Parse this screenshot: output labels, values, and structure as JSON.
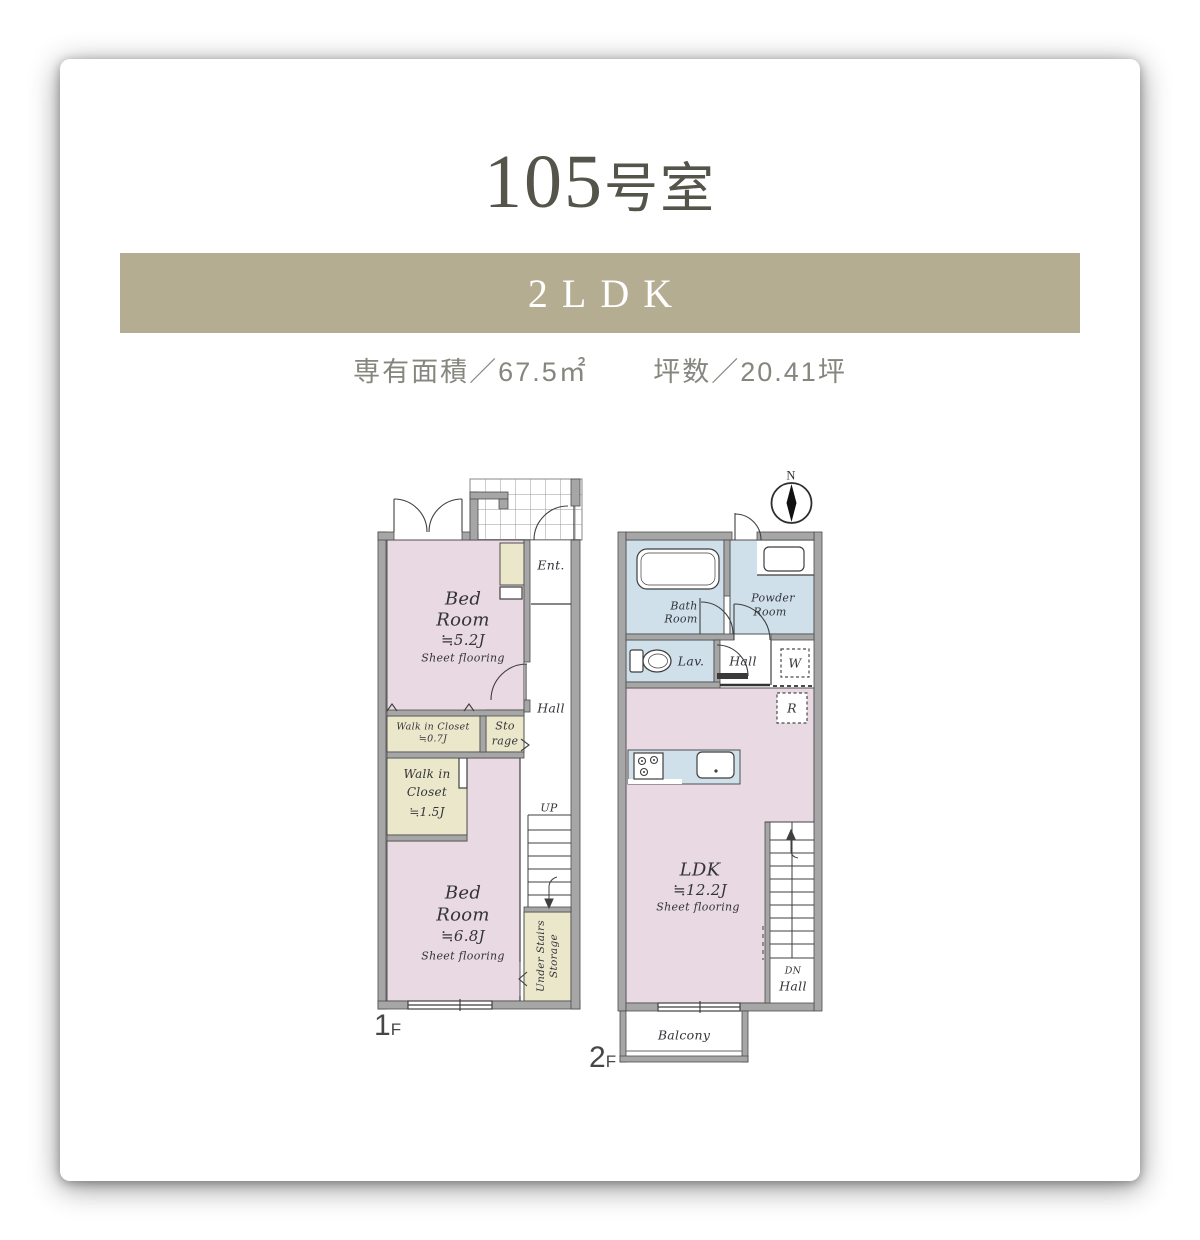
{
  "header": {
    "room_number": "105",
    "room_suffix": "号室",
    "layout_type": "2LDK",
    "area_text": "専有面積／67.5㎡",
    "tsubo_text": "坪数／20.41坪"
  },
  "colors": {
    "banner": "#b4ad92",
    "title_text": "#54544a",
    "sub_text": "#85867e",
    "room_pink": "#e9d9e2",
    "room_blue": "#cfe0ea",
    "closet_cream": "#ebe7cb",
    "wall_gray": "#a6a6a6",
    "line": "#3f3f3f"
  },
  "floor1": {
    "floor_number": "1",
    "floor_suffix": "F",
    "bedroom1": {
      "l1": "Bed",
      "l2": "Room",
      "l3": "≒5.2J",
      "l4": "Sheet flooring"
    },
    "bedroom2": {
      "l1": "Bed",
      "l2": "Room",
      "l3": "≒6.8J",
      "l4": "Sheet flooring"
    },
    "entrance": "Ent.",
    "hall": "Hall",
    "wic_small": {
      "l1": "Walk in Closet",
      "l2": "≒0.7J"
    },
    "storage": {
      "l1": "Sto",
      "l2": "rage"
    },
    "wic_large": {
      "l1": "Walk in",
      "l2": "Closet",
      "l3": "≒1.5J"
    },
    "up": "UP",
    "under_stairs": {
      "l1": "Under Stairs",
      "l2": "Storage"
    }
  },
  "floor2": {
    "floor_number": "2",
    "floor_suffix": "F",
    "compass_north": "N",
    "bath": {
      "l1": "Bath",
      "l2": "Room"
    },
    "powder": {
      "l1": "Powder",
      "l2": "Room"
    },
    "lav": "Lav.",
    "hall": "Hall",
    "washer": "W",
    "fridge": "R",
    "ldk": {
      "l1": "LDK",
      "l2": "≒12.2J",
      "l3": "Sheet flooring"
    },
    "dn": "DN",
    "dn_hall": "Hall",
    "balcony": "Balcony"
  }
}
